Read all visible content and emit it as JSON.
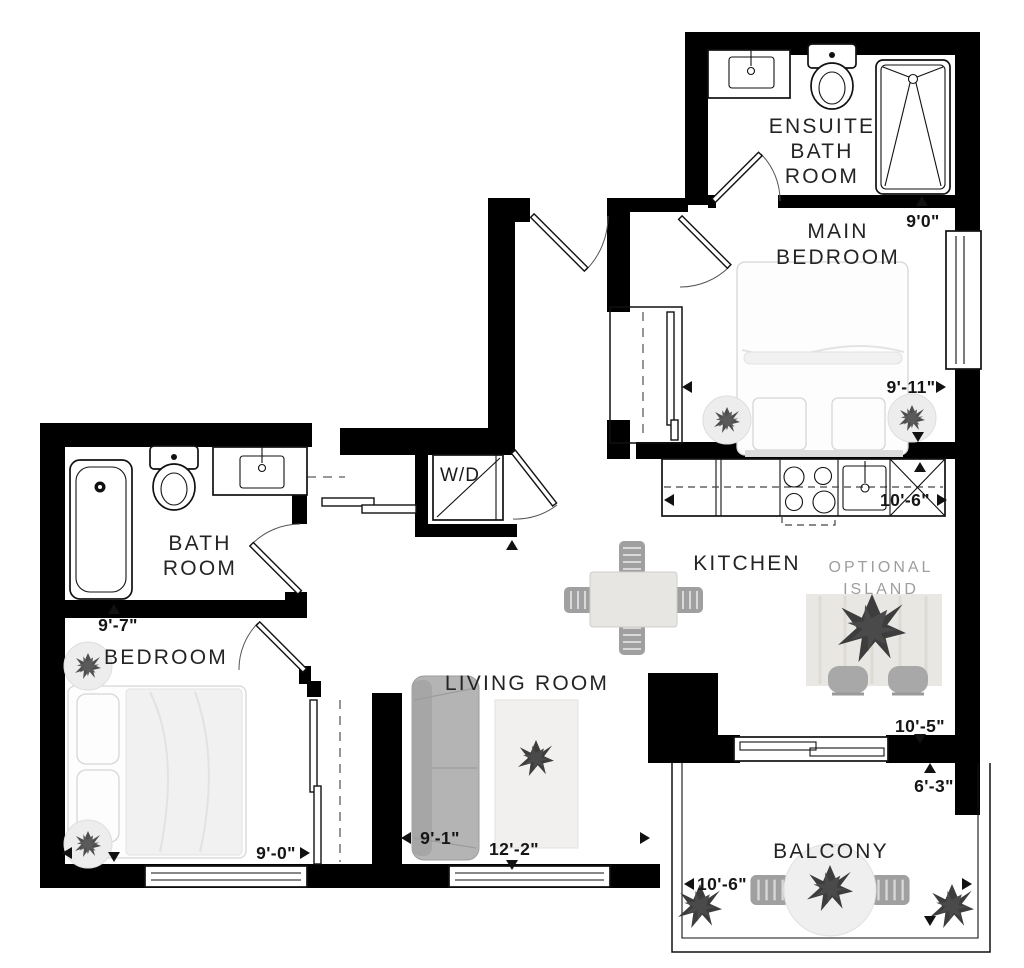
{
  "plan_title": "one-bedroom-plus-den floor plan",
  "labels": {
    "ensuite_1": "ENSUITE",
    "ensuite_2": "BATH",
    "ensuite_3": "ROOM",
    "main_bedroom_1": "MAIN",
    "main_bedroom_2": "BEDROOM",
    "kitchen": "KITCHEN",
    "island_1": "OPTIONAL",
    "island_2": "ISLAND",
    "bathroom_1": "BATH",
    "bathroom_2": "ROOM",
    "bedroom": "BEDROOM",
    "living_room": "LIVING ROOM",
    "balcony": "BALCONY",
    "washer_dryer": "W/D"
  },
  "dimensions": {
    "main_bedroom_depth": "9'0\"",
    "main_bedroom_width": "9'-11\"",
    "kitchen_width": "10'-6\"",
    "kitchen_depth": "10'-5\"",
    "balcony_depth": "6'-3\"",
    "balcony_width": "10'-6\"",
    "bedroom_depth": "9'-7\"",
    "bedroom_width": "9'-0\"",
    "living_room_width": "9'-1\"",
    "living_room_depth": "12'-2\""
  },
  "colors": {
    "wall": "#000000",
    "dimension_text": "#161616",
    "muted_label": "#9e9e9e",
    "furniture_gray": "#b4b4b4",
    "plant_dark": "#444444"
  }
}
